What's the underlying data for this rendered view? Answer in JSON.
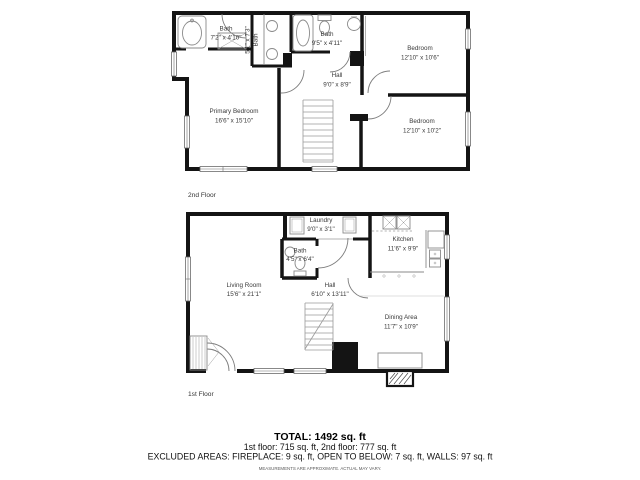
{
  "floors": {
    "second": {
      "label": "2nd Floor",
      "rooms": {
        "bath1": {
          "name": "Bath",
          "dims": "7'2\" x 4'10\""
        },
        "bath2": {
          "name": "Bath",
          "dims": "5'1\" x 7'3\""
        },
        "bath3": {
          "name": "Bath",
          "dims": "9'5\" x 4'11\""
        },
        "bedroom1": {
          "name": "Bedroom",
          "dims": "12'10\" x 10'6\""
        },
        "hall": {
          "name": "Hall",
          "dims": "9'0\" x 8'9\""
        },
        "primary": {
          "name": "Primary Bedroom",
          "dims": "16'6\" x 15'10\""
        },
        "bedroom2": {
          "name": "Bedroom",
          "dims": "12'10\" x 10'2\""
        }
      }
    },
    "first": {
      "label": "1st Floor",
      "rooms": {
        "laundry": {
          "name": "Laundry",
          "dims": "9'0\" x 3'1\""
        },
        "bath": {
          "name": "Bath",
          "dims": "4'5\" x 6'4\""
        },
        "kitchen": {
          "name": "Kitchen",
          "dims": "11'6\" x 9'9\""
        },
        "living": {
          "name": "Living Room",
          "dims": "15'6\" x 21'1\""
        },
        "hall": {
          "name": "Hall",
          "dims": "6'10\" x 13'11\""
        },
        "dining": {
          "name": "Dining Area",
          "dims": "11'7\" x 10'9\""
        }
      }
    }
  },
  "summary": {
    "total": "TOTAL: 1492 sq. ft",
    "floors_line": "1st floor: 715 sq. ft, 2nd floor: 777 sq. ft",
    "excluded_line": "EXCLUDED AREAS: FIREPLACE: 9 sq. ft, OPEN TO BELOW: 7 sq. ft, WALLS: 97 sq. ft",
    "disclaimer": "MEASUREMENTS ARE APPROXIMATE. ACTUAL MAY VARY."
  },
  "colors": {
    "wall": "#141414",
    "fixture": "#8a8a8a",
    "label_text": "#3a3a3a"
  }
}
